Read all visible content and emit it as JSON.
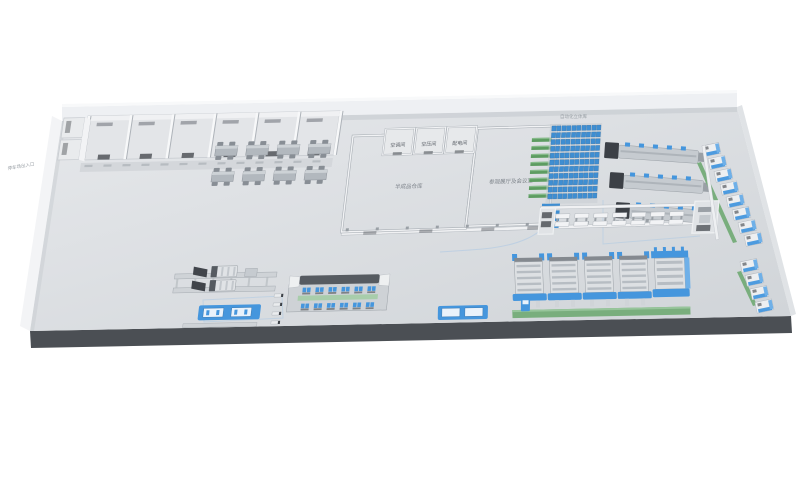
{
  "labels": {
    "outside_left": "停车场出入口",
    "storage_area": "自动化立体库",
    "room_1": "空调间",
    "room_2": "空压间",
    "room_3": "配电间",
    "hall_left": "半成品仓库",
    "hall_right": "参观展厅及会议室"
  },
  "colors": {
    "background": "#ffffff",
    "floor_light": "#e3e6e9",
    "floor_dark": "#d2d6da",
    "wall": "#f1f2f4",
    "wall_shade": "#aeb3b9",
    "plinth": "#4b4f54",
    "accent_blue": "#4596dd",
    "rack_blue": "#3e8ed2",
    "rack_blue_dark": "#2d6ba3",
    "green": "#79ae7d",
    "rack_green": "#5d9c61",
    "machine_gray": "#c6cbd0",
    "dark_gray": "#3c4046",
    "label_gray": "#8a9098",
    "route_blue": "#a9c7e4"
  },
  "layout_counts": {
    "top_rooms": 6,
    "desk_rows": 2,
    "desk_cols": 4,
    "green_shelves": 8,
    "blue_shelves": 4,
    "rack_cols": 5,
    "rack_rows": 11,
    "prod_lines": 3,
    "prod_line_dots": 5,
    "right_machines_upper": 8,
    "right_machines_lower": 4,
    "workbenches": 7,
    "big_machines": 5,
    "assembly_station_cols": 6,
    "assembly_station_rows": 2,
    "hook_items": 4
  }
}
